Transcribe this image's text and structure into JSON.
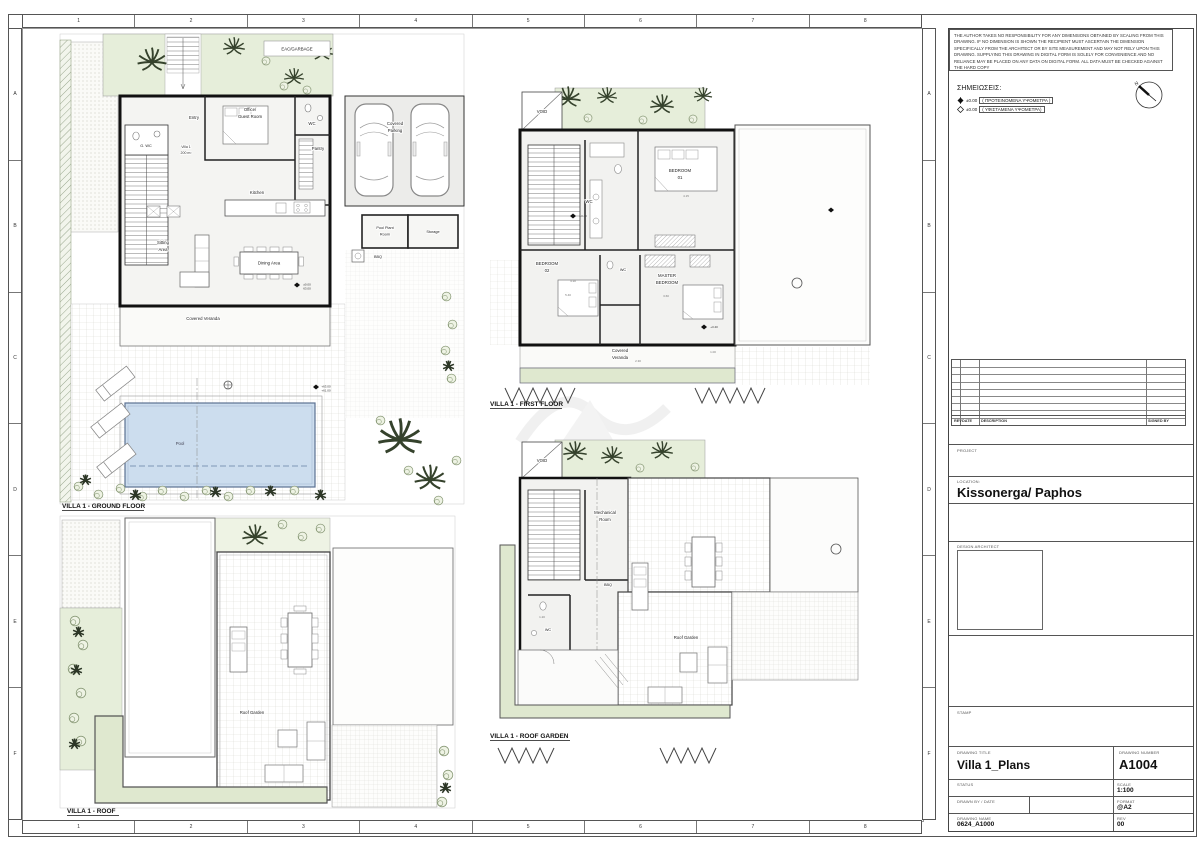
{
  "sheet": {
    "grid_cols": [
      "1",
      "2",
      "3",
      "4",
      "5",
      "6",
      "7",
      "8"
    ],
    "grid_rows": [
      "A",
      "B",
      "C",
      "D",
      "E",
      "F"
    ]
  },
  "title_block": {
    "disclaimer": "THE AUTHOR TAKES NO RESPONSIBILITY FOR ANY DIMENSIONS OBTAINED BY SCALING FROM THIS DRAWING. IF NO DIMENSION IS SHOWN THE RECIPIENT MUST ASCERTAIN THE DIMENSION SPECIFICALLY FROM THE ARCHITECT OR BY SITE MEASUREMENT AND MAY NOT RELY UPON THIS DRAWING. SUPPLYING THIS DRAWING IN DIGITAL FORM IS SOLELY FOR CONVENIENCE AND NO RELIANCE MAY BE PLACED ON ANY DATA ON DIGITAL FORM. ALL DATA MUST BE CHECKED AGAINST THE HARD COPY",
    "notes_title": "ΣΗΜΕΙΩΣΕΙΣ:",
    "note_proposed_value": "±0.00",
    "note_proposed_text": "( ΠΡΟΤΕΙΝΟΜΕΝΑ ΥΨΟΜΕΤΡΑ )",
    "note_existing_value": "±0.00",
    "note_existing_text": "( ΥΦΙΣΤΑΜΕΝΑ ΥΨΟΜΕΤΡΑ)",
    "north_label": "N",
    "rev_headers": {
      "rev": "REV",
      "date": "DATE",
      "description": "DESCRIPTION",
      "signed": "SIGNED BY"
    },
    "project_label": "PROJECT",
    "location_label": "LOCATION:",
    "location_value": "Kissonerga/ Paphos",
    "design_architect_label": "DESIGN ARCHITECT",
    "stamp_label": "STAMP",
    "drawing_title_label": "DRAWING TITLE",
    "drawing_title_value": "Villa 1_Plans",
    "drawing_number_label": "DRAWING NUMBER",
    "drawing_number_value": "A1004",
    "status_label": "STATUS",
    "scale_label": "SCALE",
    "scale_value": "1:100",
    "drawn_by_label": "DRAWN BY / DATE",
    "format_label": "FORMAT",
    "format_value": "@A2",
    "drawing_name_label": "DRAWING NAME",
    "drawing_name_value": "0624_A1000",
    "rev_label": "REV",
    "rev_value": "00"
  },
  "plans": {
    "ground": {
      "title": "VILLA 1 - GROUND FLOOR",
      "labels": {
        "eac": "EAC/GARBAGE",
        "entry": "Entry",
        "gwc": "G. WC",
        "villa": "Villa 1",
        "villa_area": "200 m²",
        "office1": "Office/",
        "office2": "Guest Room",
        "wc": "WC",
        "pantry": "Pantry",
        "kitchen": "Kitchen",
        "sitting1": "Sitting",
        "sitting2": "Area",
        "dining": "Dining Area",
        "parking1": "Covered",
        "parking2": "Parking",
        "plant1": "Pool Plant",
        "plant2": "Room",
        "storage": "Storage",
        "bbq": "BBQ",
        "veranda": "Covered Veranda",
        "pool": "Pool",
        "elev_zero": "±0.00",
        "elev_63": "63.00",
        "elev_63p": "+63.00",
        "elev_61p": "+61.00"
      }
    },
    "first": {
      "title": "VILLA 1 - FIRST FLOOR",
      "labels": {
        "void": "VOID",
        "bed1a": "BEDROOM",
        "bed1b": "01",
        "bed2a": "BEDROOM",
        "bed2b": "02",
        "wc": "WC",
        "wc2": "WC",
        "master1": "MASTER",
        "master2": "BEDROOM",
        "veranda1": "Covered",
        "veranda2": "Veranda",
        "elev": "+3.40"
      },
      "dims": {
        "d1": "4.15",
        "d2": "3.60",
        "d3": "4.30",
        "d4": "5.40",
        "d5": "2.30",
        "d6": "1.00"
      }
    },
    "roof_garden": {
      "title": "VILLA 1 - ROOF GARDEN",
      "labels": {
        "void": "VOID",
        "mech1": "Mechanical",
        "mech2": "Room",
        "wc": "WC",
        "bbq": "BBQ",
        "garden": "Roof Garden"
      },
      "dims": {
        "d1": "1.20"
      }
    },
    "roof": {
      "title": "VILLA 1 - ROOF",
      "labels": {
        "garden": "Roof Garden"
      }
    }
  },
  "colors": {
    "garden_green": "#e6eeda",
    "planter_green": "#dfe8cf",
    "pool_blue": "#ccddee",
    "wall_black": "#111111"
  }
}
